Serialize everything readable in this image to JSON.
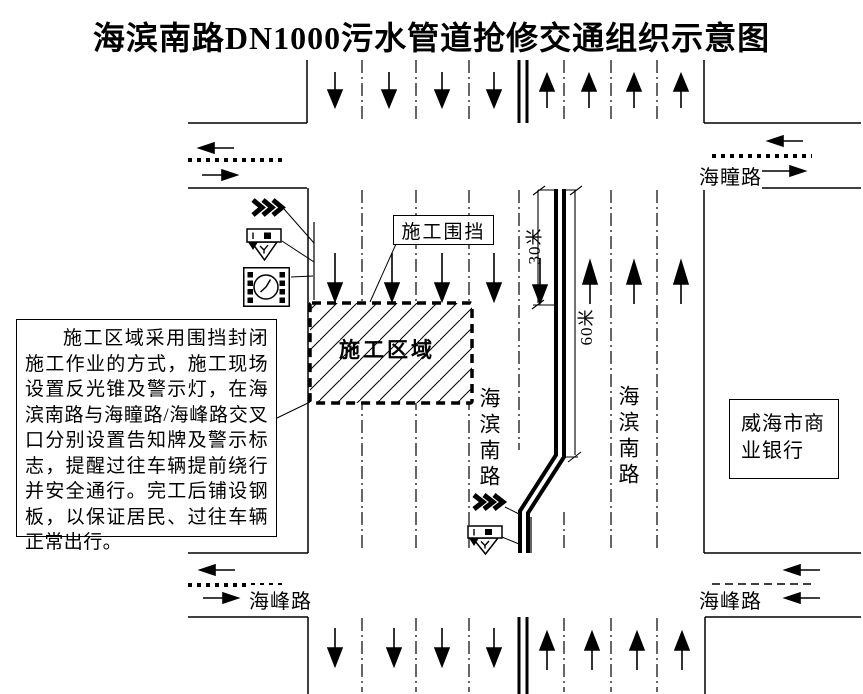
{
  "title": "海滨南路DN1000污水管道抢修交通组织示意图",
  "labels": {
    "construction_zone": "施工区域",
    "construction_fence": "施工围挡",
    "main_road_left": "海滨南路",
    "main_road_right": "海滨南路",
    "north_cross_road": "海瞳路",
    "south_cross_road_left": "海峰路",
    "south_cross_road_right": "海峰路",
    "bank": "威海市商业银行"
  },
  "dimensions": {
    "taper_length": "30米",
    "fence_length": "60米"
  },
  "note": {
    "text": "施工区域采用围挡封闭施工作业的方式，施工现场设置反光锥及警示灯，在海滨南路与海瞳路/海峰路交叉口分别设置告知牌及警示标志，提醒过往车辆提前绕行并安全通行。完工后铺设钢板，以保证居民、过往车辆正常出行。"
  },
  "icons": [
    "detour-chevrons-icon",
    "construction-warning-sign-icon",
    "notice-board-icon"
  ],
  "traffic": {
    "left_carriageway_direction": "down",
    "right_carriageway_direction": "up",
    "lanes_per_side_normal": 4,
    "southbound_lanes_at_workzone": 5,
    "northbound_lanes_at_workzone": 3
  },
  "colors": {
    "ink": "#000000",
    "background": "#ffffff"
  }
}
